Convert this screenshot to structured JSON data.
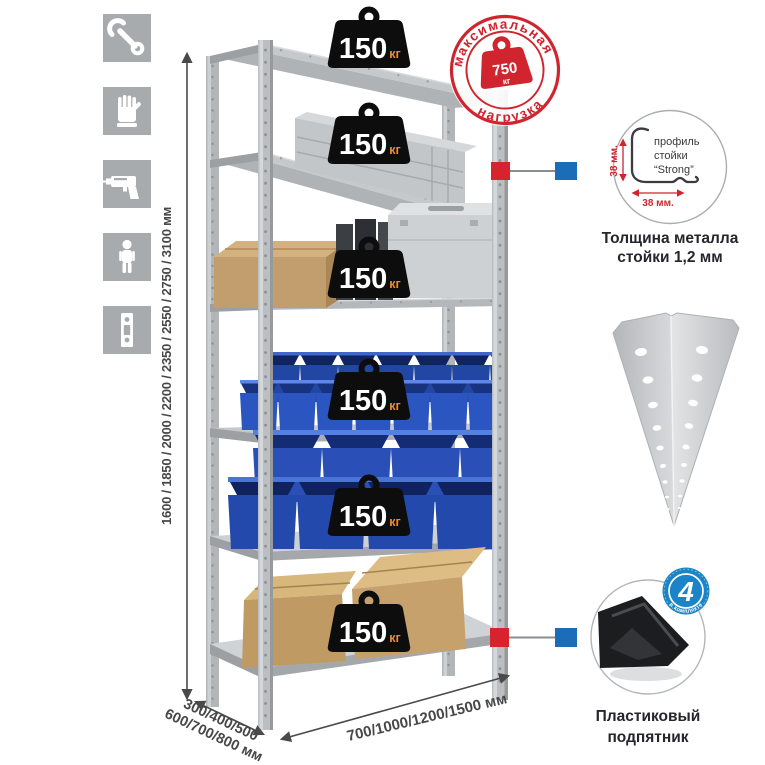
{
  "canvas": {
    "background": "#ffffff"
  },
  "assembly_icons": [
    {
      "name": "wrench-icon"
    },
    {
      "name": "gloves-icon"
    },
    {
      "name": "drill-icon"
    },
    {
      "name": "person-icon"
    },
    {
      "name": "upright-strip-icon"
    }
  ],
  "dimensions": {
    "height_options": "1600 / 1850 / 2000 / 2200 / 2350 / 2550 / 2750 / 3100 мм",
    "depth_line1": "300/400/500",
    "depth_line2": "600/700/800 мм",
    "width_options": "700/1000/1200/1500 мм"
  },
  "rack": {
    "shelf_count": 6,
    "shelves": [
      {
        "load_value": "150",
        "load_unit": "кг"
      },
      {
        "load_value": "150",
        "load_unit": "кг"
      },
      {
        "load_value": "150",
        "load_unit": "кг"
      },
      {
        "load_value": "150",
        "load_unit": "кг"
      },
      {
        "load_value": "150",
        "load_unit": "кг"
      },
      {
        "load_value": "150",
        "load_unit": "кг"
      }
    ]
  },
  "max_load_stamp": {
    "arc_top": "максимальная",
    "arc_bottom": "нагрузка",
    "value": "750",
    "unit": "кг",
    "color": "#d0242e"
  },
  "profile_detail": {
    "label_line1": "профиль",
    "label_line2": "стойки",
    "label_line3": "“Strong”",
    "dim_vertical": "38 мм.",
    "dim_horizontal": "38 мм.",
    "caption_line1": "Толщина металла",
    "caption_line2": "стойки 1,2 мм"
  },
  "foot_detail": {
    "badge_value": "4",
    "badge_arc": "в комплекте",
    "badge_color": "#1a84c6",
    "caption_line1": "Пластиковый",
    "caption_line2": "подпятник"
  },
  "colors": {
    "stamp_red": "#d0242e",
    "connector_red": "#d6232e",
    "connector_blue": "#1c6db8",
    "bin_blue": "#2b55c0",
    "metal_gray": "#c8cbce",
    "icon_gray": "#a7abad"
  }
}
